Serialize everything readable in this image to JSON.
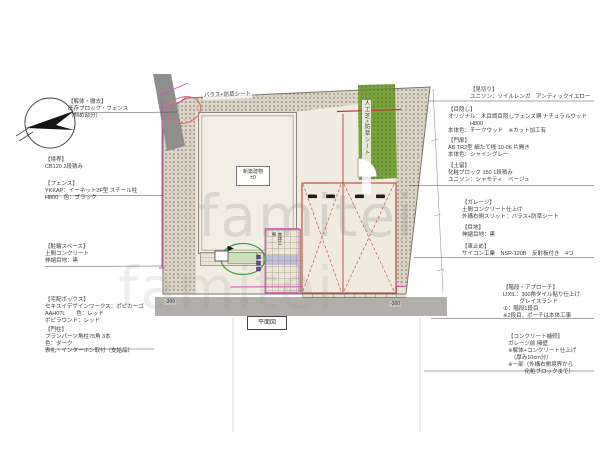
{
  "watermark": "famitei",
  "plan": {
    "balast_label": "バラス+防草シート",
    "turf_label": "人工芝+防草シート",
    "building_label": "新築建物",
    "building_level": "±0",
    "plan_title": "平面図",
    "porch_note": "本体工事",
    "level_left": "-300",
    "level_right": "-300"
  },
  "colors": {
    "boundary_magenta": "#d84fae",
    "garage_red": "#b5413a",
    "turf_green": "#7aa23c",
    "highlight_green": "#3f9b45",
    "highlight_red": "#e06b6b"
  },
  "annotations": {
    "left": [
      {
        "title": "【解体・撤去】",
        "lines": [
          "既存ブロック・フェンス",
          "（斜め部分）"
        ]
      },
      {
        "title": "【境界】",
        "lines": [
          "CB120 2段積み"
        ]
      },
      {
        "title": "【フェンス】",
        "lines": [
          "YKKAP：イーネット2F型 スチール柱",
          "H800　色：ブラック"
        ]
      },
      {
        "title": "【駐輪スペース】",
        "lines": [
          "土間コンクリート",
          "伸縮目地：黒"
        ]
      },
      {
        "title": "【宅配ボックス】",
        "lines": [
          "セキスイデザインワークス：ポピカーゴ",
          "AAH07L　　色：レッド",
          "ポピラウンド：レッド"
        ]
      },
      {
        "title": "【門柱】",
        "lines": [
          "プランパーツ角柱75角 3本",
          "色：ダーク",
          "表札・インターホン取付（支給品）"
        ]
      }
    ],
    "right": [
      {
        "title": "【見切り】",
        "lines": [
          "ユニソン：ソイルレンガ　アンティックイエロー"
        ]
      },
      {
        "title": "【目隠し】",
        "lines": [
          "オリジナル：木目調目隠しフェンス塀 ナチュラルウッド",
          "　　　　H800",
          "本体色：チークウッド　※カット加工有"
        ]
      },
      {
        "title": "【門扉】",
        "lines": [
          "AB TR2型 細たて桟 10-06 片開き",
          "本体色：シャイングレー"
        ]
      },
      {
        "title": "【土留】",
        "lines": [
          "化粧ブロック 150 1段積み",
          "ユニソン：シャモティ　ベージュ"
        ]
      },
      {
        "title": "【ガレージ】",
        "lines": [
          "土間コンクリート仕上げ",
          "外構右側スリット：バラス+防草シート"
        ]
      },
      {
        "title": "【目地】",
        "lines": [
          "伸縮目地：黒"
        ]
      },
      {
        "title": "【車止め】",
        "lines": [
          "サイコン工業　NSP-120B　反射板付き　4つ"
        ]
      },
      {
        "title": "【階段・アプローチ】",
        "lines": [
          "LIXIL：300角タイル貼り仕上げ",
          "　　　グレイスランド",
          "①：階段1段目",
          "※2段目、ポーチは本体工事"
        ]
      },
      {
        "title": "【コンクリート補修】",
        "lines": [
          "ガレージ前 擁壁",
          "※解体+コンクリート仕上げ",
          "　（厚み10cm分）",
          "※一部（外構右側境界から",
          "　　　化粧ブロックまで）"
        ]
      }
    ]
  }
}
